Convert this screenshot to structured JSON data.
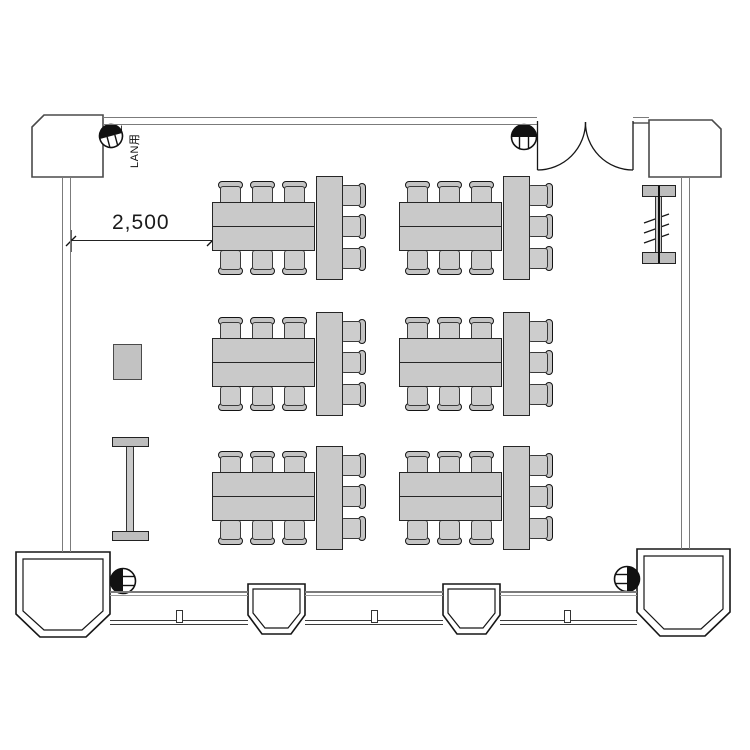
{
  "drawing": {
    "type": "floor-plan",
    "room": "classroom / meeting room",
    "dimension_label": "2,500",
    "lan_label": "LAN用",
    "lan_count": "2"
  },
  "furniture": {
    "cluster_origins": [
      [
        212,
        176
      ],
      [
        399,
        176
      ],
      [
        212,
        312
      ],
      [
        399,
        312
      ],
      [
        212,
        446
      ],
      [
        399,
        446
      ]
    ],
    "h_table": {
      "x": 0,
      "y": 26,
      "w": 103,
      "h": 49
    },
    "v_table": {
      "x": 104,
      "y": 0,
      "w": 27,
      "h": 104
    },
    "chairs": [
      {
        "x": 6,
        "y": 5,
        "o": "top"
      },
      {
        "x": 38,
        "y": 5,
        "o": "top"
      },
      {
        "x": 70,
        "y": 5,
        "o": "top"
      },
      {
        "x": 6,
        "y": 74,
        "o": "bottom"
      },
      {
        "x": 38,
        "y": 74,
        "o": "bottom"
      },
      {
        "x": 70,
        "y": 74,
        "o": "bottom"
      },
      {
        "x": 129,
        "y": 7,
        "o": "right"
      },
      {
        "x": 129,
        "y": 38,
        "o": "right"
      },
      {
        "x": 129,
        "y": 70,
        "o": "right"
      }
    ],
    "tables_per_cluster": 3,
    "chairs_per_cluster": 9,
    "cluster_count": 6
  },
  "colors": {
    "furniture_fill": "#c9c9c9",
    "furniture_border": "#262626",
    "wall_gray": "#7b7b7b",
    "line_dark": "#161616",
    "background": "#ffffff"
  }
}
